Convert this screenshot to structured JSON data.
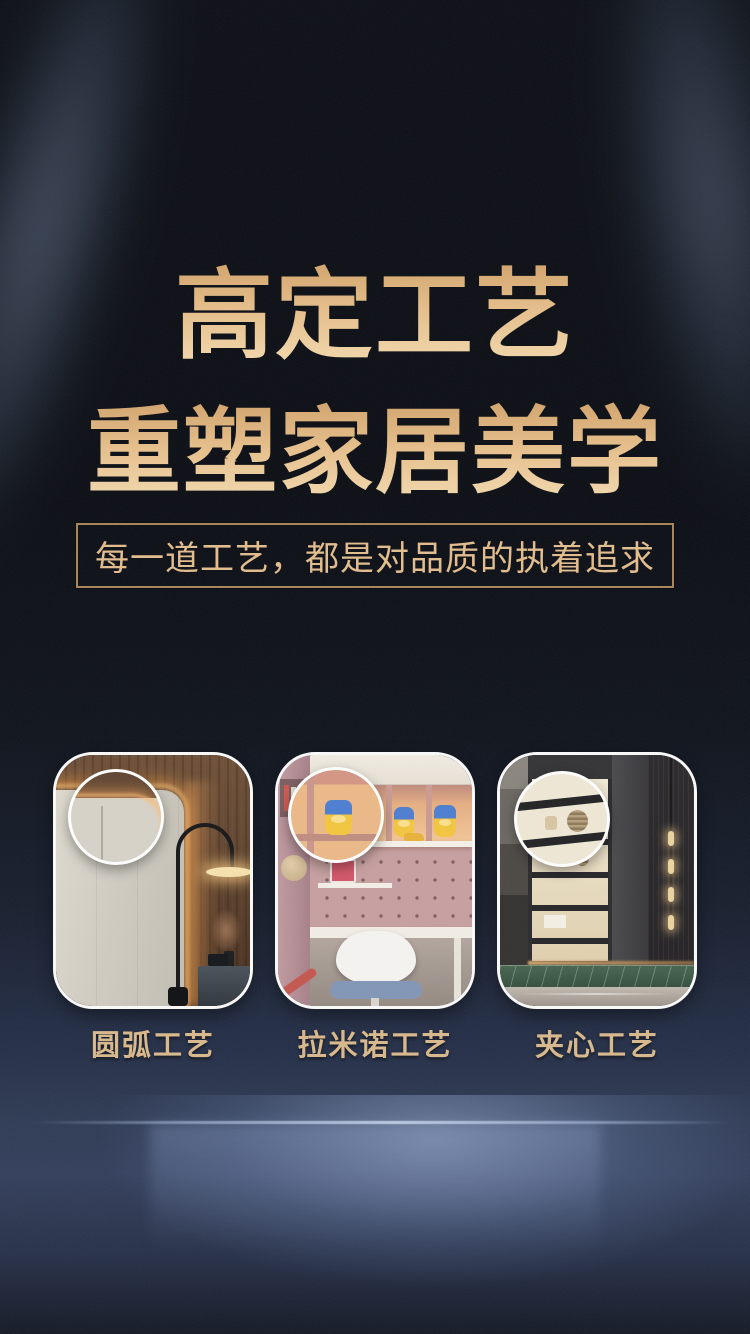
{
  "page": {
    "headline": {
      "line1": "高定工艺",
      "line2": "重塑家居美学"
    },
    "subtitle": "每一道工艺，都是对品质的执着追求",
    "colors": {
      "headline_gold_top": "#cd9c63",
      "headline_gold_bottom": "#f4dcb2",
      "subtitle_gold": "#e3bd8d",
      "subtitle_border_gold": "#a9855a",
      "label_gold": "#d9b88c",
      "background_dark_navy": "#0c0f15",
      "glow_blue": "#a8bce2",
      "card_border_white": "#fafafa"
    }
  },
  "cards": [
    {
      "label": "圆弧工艺",
      "image_alt": "bedroom wardrobe with rounded-corner panel, LED strip and arc floor lamp, magnifier on rounded edge"
    },
    {
      "label": "拉米诺工艺",
      "image_alt": "kids study with pegboard wall, toy shelves and desk chair, magnifier on shelf joint"
    },
    {
      "label": "夹心工艺",
      "image_alt": "living room display shelving with slat wall and green marble base, magnifier on shelf edge"
    }
  ]
}
